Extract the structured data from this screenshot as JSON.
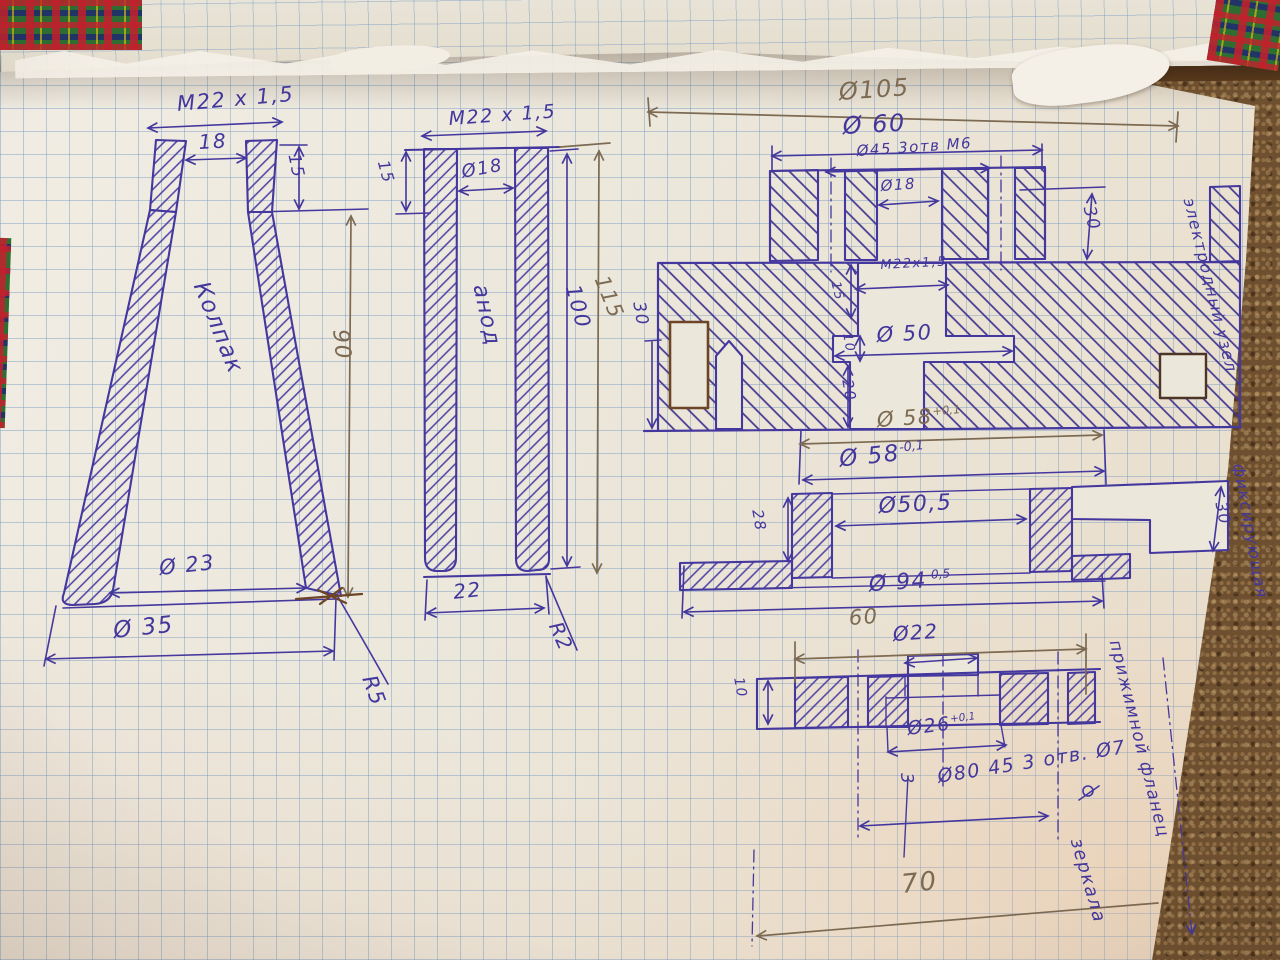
{
  "palette": {
    "ink": "#43379c",
    "ink2": "#5a3aa8",
    "pencil": "#7c6a52",
    "brown": "#6d4526"
  },
  "annotations": [
    {
      "id": "dim-thread-left",
      "text": "М22 х 1,5",
      "x": 176,
      "y": 92,
      "rot": -5,
      "size": 21,
      "color": "ink"
    },
    {
      "id": "dim-18-left",
      "text": "18",
      "x": 198,
      "y": 130,
      "rot": -3,
      "size": 20,
      "color": "ink"
    },
    {
      "id": "dim-15-left",
      "text": "15",
      "x": 303,
      "y": 152,
      "rot": 78,
      "size": 17,
      "color": "ink"
    },
    {
      "id": "label-kolpak",
      "text": "Колпак",
      "x": 212,
      "y": 278,
      "rot": 68,
      "size": 23,
      "color": "ink"
    },
    {
      "id": "dim-90",
      "text": "90",
      "x": 352,
      "y": 328,
      "rot": 84,
      "size": 22,
      "color": "pencil"
    },
    {
      "id": "dim-d23",
      "text": "Ø 23",
      "x": 158,
      "y": 556,
      "rot": -6,
      "size": 21,
      "color": "ink"
    },
    {
      "id": "dim-d35",
      "text": "Ø 35",
      "x": 112,
      "y": 618,
      "rot": -6,
      "size": 23,
      "color": "ink"
    },
    {
      "id": "dim-r5",
      "text": "R5",
      "x": 380,
      "y": 672,
      "rot": 70,
      "size": 21,
      "color": "ink"
    },
    {
      "id": "dim-thread-mid",
      "text": "М22 х 1,5",
      "x": 448,
      "y": 108,
      "rot": -4,
      "size": 19,
      "color": "ink"
    },
    {
      "id": "dim-15-mid",
      "text": "15",
      "x": 392,
      "y": 158,
      "rot": 74,
      "size": 16,
      "color": "ink"
    },
    {
      "id": "dim-d18-mid",
      "text": "Ø18",
      "x": 460,
      "y": 162,
      "rot": -10,
      "size": 18,
      "color": "ink"
    },
    {
      "id": "label-anod",
      "text": "анод",
      "x": 492,
      "y": 282,
      "rot": 78,
      "size": 22,
      "color": "ink"
    },
    {
      "id": "dim-100",
      "text": "100",
      "x": 584,
      "y": 282,
      "rot": 75,
      "size": 21,
      "color": "ink"
    },
    {
      "id": "dim-115",
      "text": "115",
      "x": 612,
      "y": 272,
      "rot": 68,
      "size": 21,
      "color": "pencil"
    },
    {
      "id": "dim-22-mid",
      "text": "22",
      "x": 452,
      "y": 580,
      "rot": -6,
      "size": 20,
      "color": "ink"
    },
    {
      "id": "dim-r2",
      "text": "R2",
      "x": 566,
      "y": 618,
      "rot": 66,
      "size": 20,
      "color": "ink"
    },
    {
      "id": "dim-d105",
      "text": "Ø105",
      "x": 838,
      "y": 78,
      "rot": -4,
      "size": 24,
      "color": "pencil"
    },
    {
      "id": "dim-d60",
      "text": "Ø 60",
      "x": 842,
      "y": 112,
      "rot": -3,
      "size": 24,
      "color": "ink"
    },
    {
      "id": "dim-d45-3otv-m6",
      "text": "Ø45 3отв М6",
      "x": 856,
      "y": 142,
      "rot": -4,
      "size": 15,
      "color": "ink"
    },
    {
      "id": "dim-d18-rt",
      "text": "Ø18",
      "x": 880,
      "y": 177,
      "rot": -4,
      "size": 15,
      "color": "ink"
    },
    {
      "id": "dim-30-rt-right",
      "text": "30",
      "x": 1098,
      "y": 204,
      "rot": 76,
      "size": 17,
      "color": "ink"
    },
    {
      "id": "dim-thread-rt",
      "text": "М22х1,5",
      "x": 880,
      "y": 258,
      "rot": -3,
      "size": 13,
      "color": "ink"
    },
    {
      "id": "dim-15-rt",
      "text": "15",
      "x": 842,
      "y": 280,
      "rot": 76,
      "size": 13,
      "color": "ink"
    },
    {
      "id": "dim-d50",
      "text": "Ø 50",
      "x": 876,
      "y": 323,
      "rot": -3,
      "size": 21,
      "color": "ink"
    },
    {
      "id": "dim-10-rt",
      "text": "10",
      "x": 854,
      "y": 332,
      "rot": 80,
      "size": 13,
      "color": "ink"
    },
    {
      "id": "dim-20-rt",
      "text": "20",
      "x": 856,
      "y": 378,
      "rot": 80,
      "size": 15,
      "color": "ink"
    },
    {
      "id": "dim-30-rt-left",
      "text": "30",
      "x": 648,
      "y": 300,
      "rot": 80,
      "size": 17,
      "color": "ink"
    },
    {
      "id": "dim-d58-plus",
      "text": "Ø 58",
      "sup": "+0,1",
      "x": 876,
      "y": 408,
      "rot": -4,
      "size": 21,
      "color": "pencil"
    },
    {
      "id": "dim-d58-minus",
      "text": "Ø 58",
      "sup": "-0,1",
      "x": 838,
      "y": 446,
      "rot": -6,
      "size": 23,
      "color": "ink"
    },
    {
      "id": "note-electrode-unit",
      "text": "электродный узел",
      "x": 1198,
      "y": 196,
      "rot": 76,
      "size": 16,
      "color": "ink"
    },
    {
      "id": "dim-28",
      "text": "28",
      "x": 766,
      "y": 508,
      "rot": 80,
      "size": 15,
      "color": "ink"
    },
    {
      "id": "dim-d50-5",
      "text": "Ø50,5",
      "x": 878,
      "y": 494,
      "rot": -3,
      "size": 22,
      "color": "ink"
    },
    {
      "id": "dim-d94",
      "text": "Ø 94",
      "sup": "-0,5",
      "x": 868,
      "y": 572,
      "rot": -4,
      "size": 22,
      "color": "ink"
    },
    {
      "id": "dim-30-mid-right",
      "text": "30",
      "x": 1230,
      "y": 500,
      "rot": 78,
      "size": 16,
      "color": "ink"
    },
    {
      "id": "note-fixing",
      "text": "фиксирующая",
      "x": 1248,
      "y": 462,
      "rot": 80,
      "size": 16,
      "color": "ink"
    },
    {
      "id": "dim-60-bottom",
      "text": "60",
      "x": 848,
      "y": 606,
      "rot": -4,
      "size": 21,
      "color": "pencil"
    },
    {
      "id": "dim-d22-bottom",
      "text": "Ø22",
      "x": 892,
      "y": 622,
      "rot": -4,
      "size": 20,
      "color": "ink"
    },
    {
      "id": "dim-10-bottom",
      "text": "10",
      "x": 746,
      "y": 676,
      "rot": 80,
      "size": 14,
      "color": "ink"
    },
    {
      "id": "dim-d26",
      "text": "Ø26",
      "sup": "+0,1",
      "x": 906,
      "y": 718,
      "rot": -7,
      "size": 19,
      "color": "ink"
    },
    {
      "id": "dim-3-sideways",
      "text": "3",
      "x": 916,
      "y": 772,
      "rot": 85,
      "size": 17,
      "color": "ink"
    },
    {
      "id": "dim-d80-3otv-d7",
      "text": "Ø80 45 3 отв. Ø7",
      "x": 936,
      "y": 766,
      "rot": -9,
      "size": 19,
      "color": "ink"
    },
    {
      "id": "dim-70",
      "text": "70",
      "x": 900,
      "y": 870,
      "rot": -6,
      "size": 26,
      "color": "pencil"
    },
    {
      "id": "note-flange-line1",
      "text": "прижимной фланец",
      "x": 1124,
      "y": 638,
      "rot": 76,
      "size": 17,
      "color": "ink"
    },
    {
      "id": "note-flange-line2",
      "text": "зеркала",
      "x": 1086,
      "y": 836,
      "rot": 74,
      "size": 18,
      "color": "ink"
    }
  ]
}
